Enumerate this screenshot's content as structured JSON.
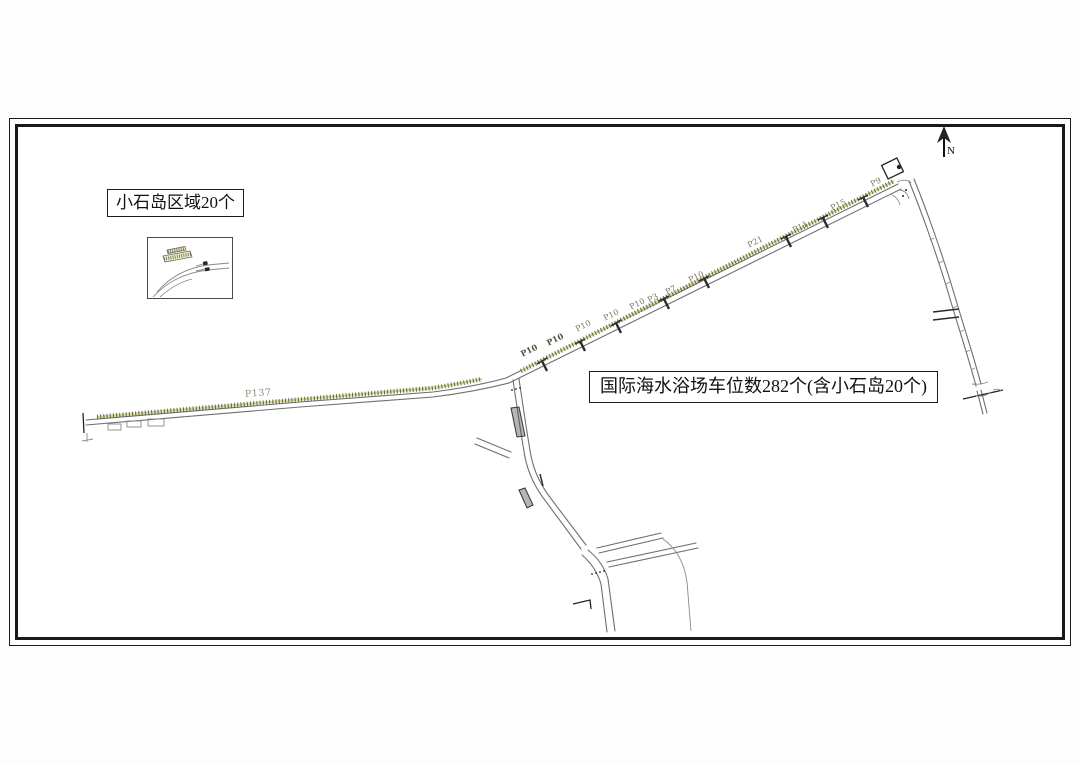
{
  "drawing": {
    "region_label": "小石岛区域20个",
    "total_label": "国际海水浴场车位数282个(含小石岛20个)",
    "compass_label": "N"
  },
  "road_labels": [
    {
      "text": "P137"
    },
    {
      "text": "P10"
    },
    {
      "text": "P10"
    },
    {
      "text": "P10"
    },
    {
      "text": "P10"
    },
    {
      "text": "P10"
    },
    {
      "text": "P3"
    },
    {
      "text": "P7"
    },
    {
      "text": "P10"
    },
    {
      "text": "P21"
    },
    {
      "text": "P11"
    },
    {
      "text": "P15"
    },
    {
      "text": "P9"
    }
  ],
  "colors": {
    "road_line": "#6f6f6f",
    "parking_tick": "#45453a",
    "parking_tint": "#d9d98e",
    "label_text": "#76765c",
    "frame": "#1a1a1a"
  }
}
